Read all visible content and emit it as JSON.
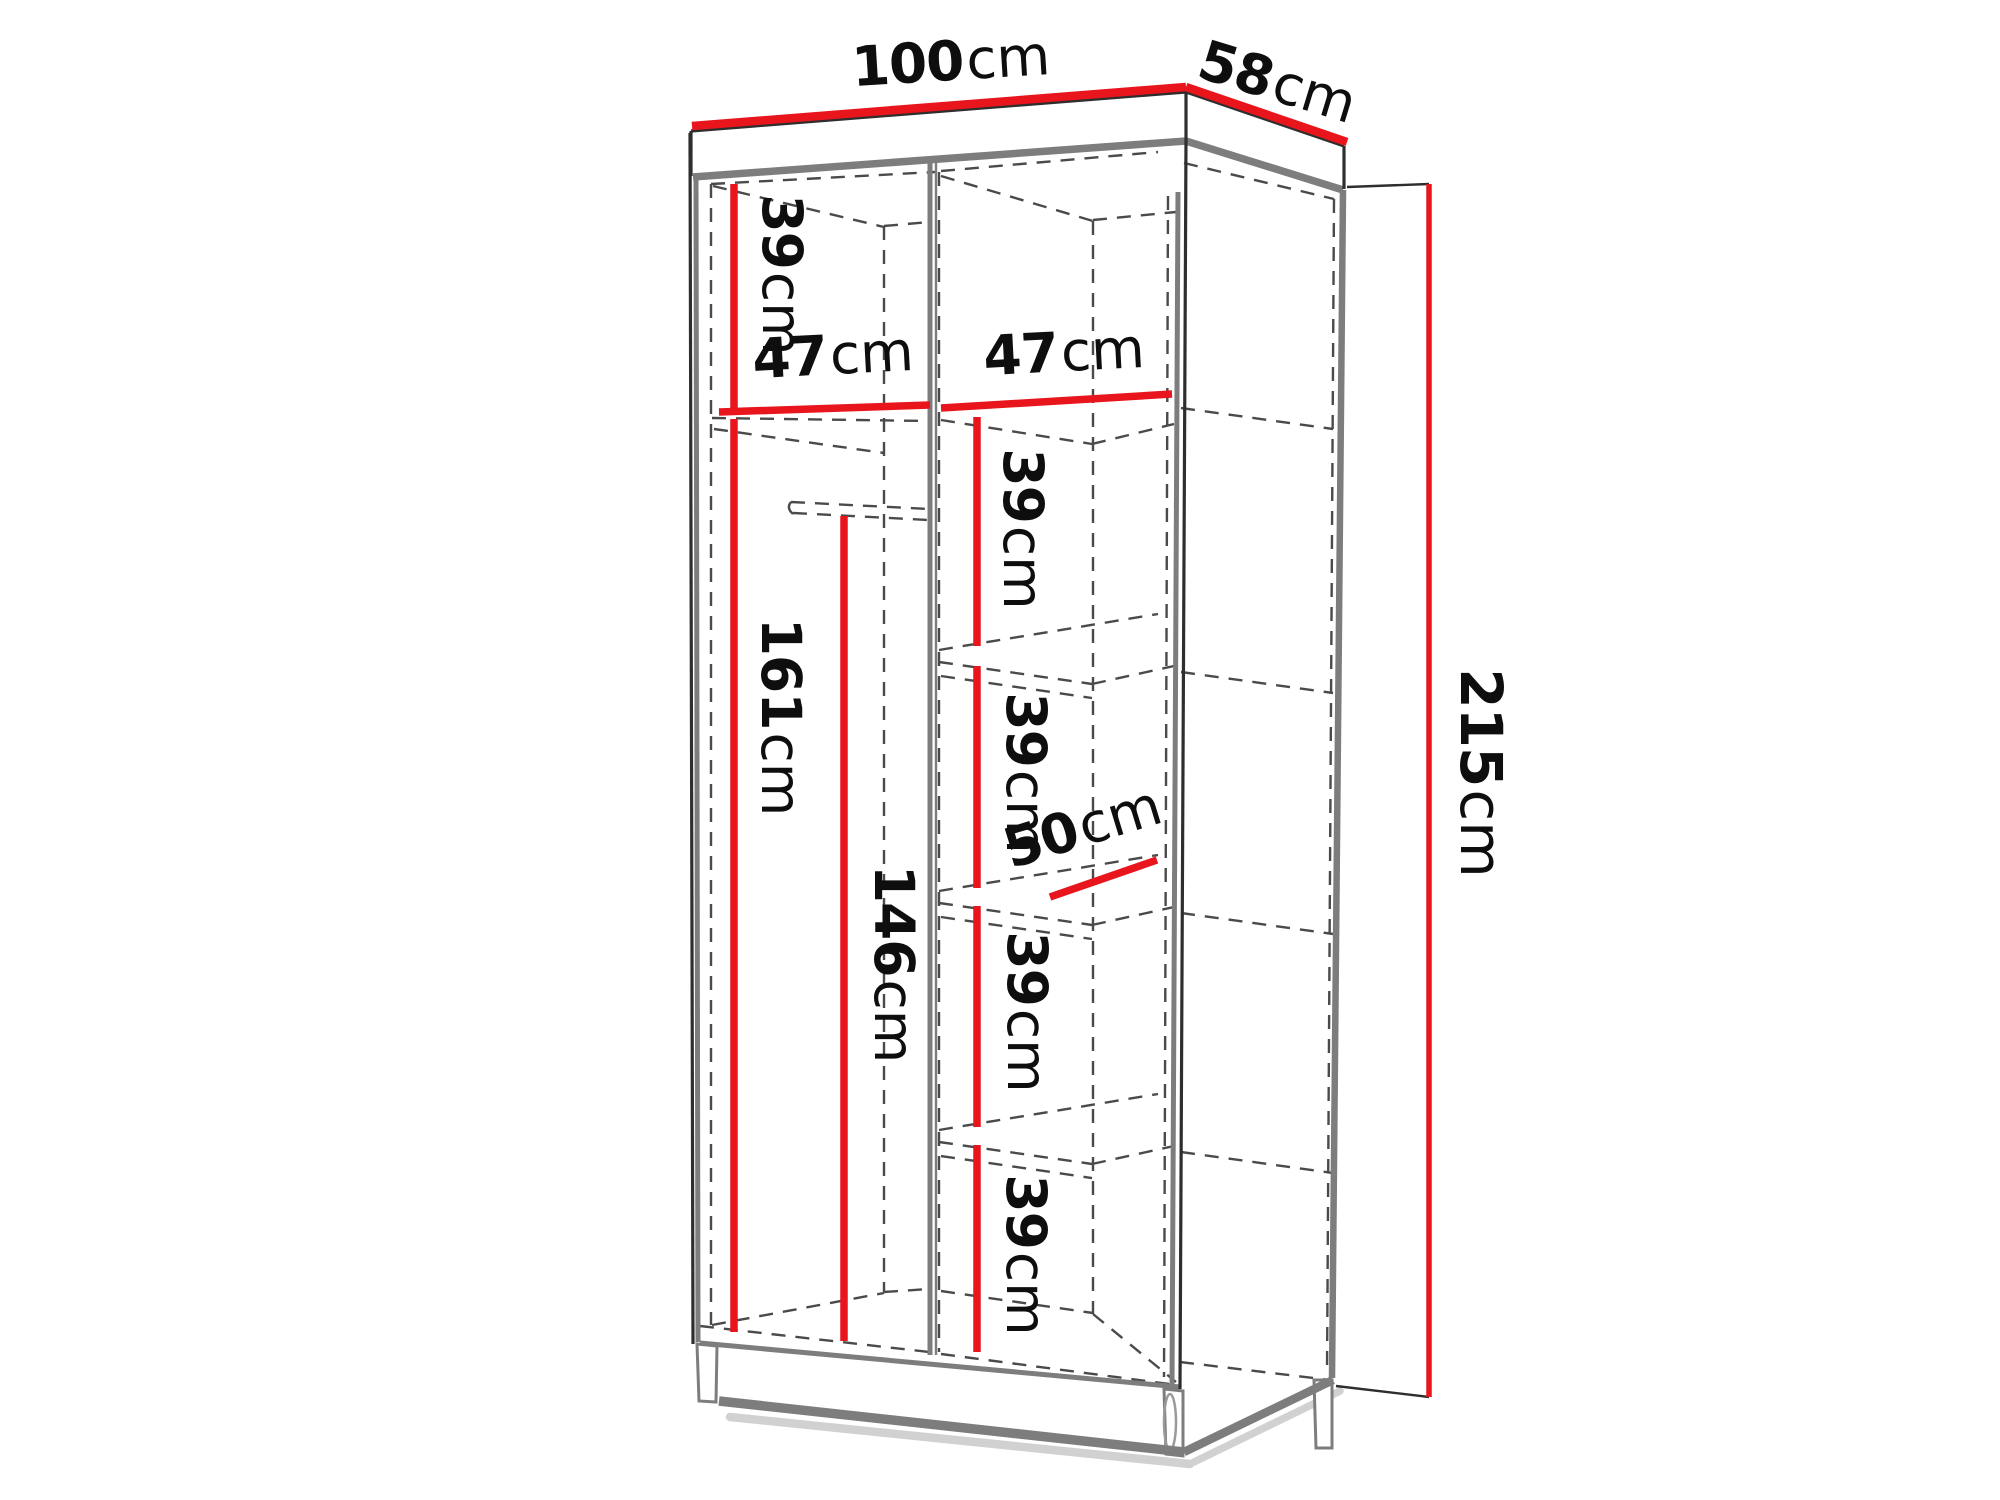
{
  "diagram": {
    "type": "furniture-dimension-diagram",
    "subject": "wardrobe interior dimensions, perspective line drawing"
  },
  "colors": {
    "dimension_red": "#e8151c",
    "edge_dark": "#2e2e2e",
    "edge_gray": "#7d7d7d",
    "dash_gray": "#4a4a4a",
    "shadow_gray": "#c6c6c6",
    "label_black": "#0e0e0e"
  },
  "labels": {
    "width": {
      "value": "100",
      "unit": "cm"
    },
    "depth": {
      "value": "58",
      "unit": "cm"
    },
    "height": {
      "value": "215",
      "unit": "cm"
    },
    "top_section": {
      "value": "39",
      "unit": "cm"
    },
    "left_width": {
      "value": "47",
      "unit": "cm"
    },
    "right_width": {
      "value": "47",
      "unit": "cm"
    },
    "hanging_height": {
      "value": "161",
      "unit": "cm"
    },
    "rail_height": {
      "value": "146",
      "unit": "cm"
    },
    "shelf_depth": {
      "value": "50",
      "unit": "cm"
    },
    "shelf_1": {
      "value": "39",
      "unit": "cm"
    },
    "shelf_2": {
      "value": "39",
      "unit": "cm"
    },
    "shelf_3": {
      "value": "39",
      "unit": "cm"
    },
    "shelf_4": {
      "value": "39",
      "unit": "cm"
    }
  }
}
